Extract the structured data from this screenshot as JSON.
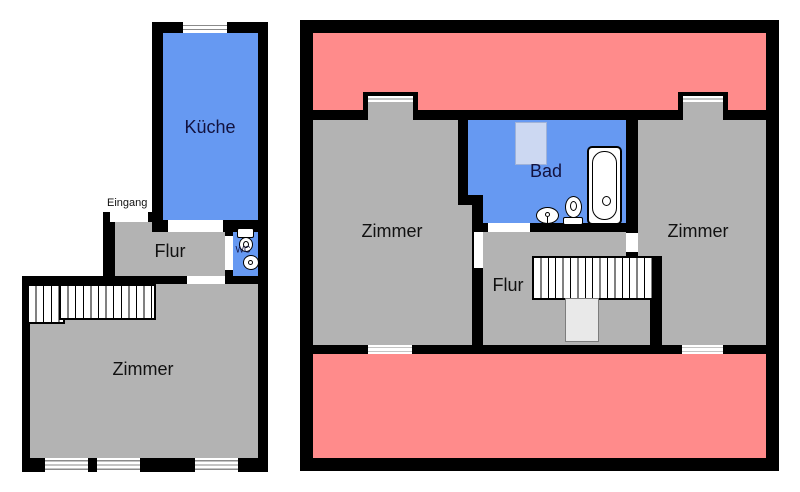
{
  "colors": {
    "wall": "#000000",
    "room-gray": "#b3b3b3",
    "room-blue": "#6699f2",
    "roof-red": "#ff8b8b",
    "shower-blue": "#ccd8f2",
    "chimney-gray": "#e9e9e9",
    "window-frame": "#8a8a8a",
    "label-dark": "#111111",
    "label-navy": "#12123f"
  },
  "plans": {
    "ground": {
      "labels": {
        "kueche": "Küche",
        "eingang": "Eingang",
        "flur": "Flur",
        "wc": "WC",
        "zimmer": "Zimmer"
      }
    },
    "upper": {
      "labels": {
        "zimmer_left": "Zimmer",
        "bad": "Bad",
        "flur": "Flur",
        "zimmer_right": "Zimmer"
      }
    }
  }
}
